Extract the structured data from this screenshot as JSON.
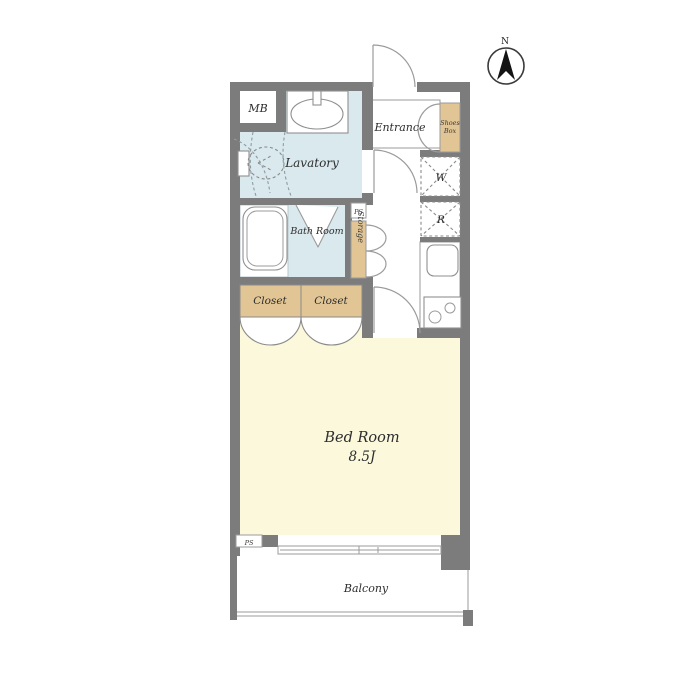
{
  "meta": {
    "kind": "apartment-floor-plan"
  },
  "colors": {
    "wall_gray": "#7c7c7c",
    "water_blue": "#d9e9ee",
    "wood_tan": "#e2c594",
    "bedroom_yellow": "#fbf8dc",
    "line_gray": "#9b9b9b"
  },
  "compass": {
    "label": "N"
  },
  "rooms": {
    "mb": {
      "label": "MB"
    },
    "lavatory": {
      "label": "Lavatory"
    },
    "entrance": {
      "label": "Entrance"
    },
    "shoes_box": {
      "label_line1": "Shoes",
      "label_line2": "Box"
    },
    "washer": {
      "label": "W"
    },
    "fridge": {
      "label": "R"
    },
    "ps_upper": {
      "label": "PS"
    },
    "storage": {
      "label": "Storage"
    },
    "bath": {
      "label": "Bath Room"
    },
    "closet_left": {
      "label": "Closet"
    },
    "closet_right": {
      "label": "Closet"
    },
    "bedroom": {
      "label": "Bed Room",
      "size": "8.5J"
    },
    "ps_lower": {
      "label": "PS"
    },
    "balcony": {
      "label": "Balcony"
    }
  }
}
